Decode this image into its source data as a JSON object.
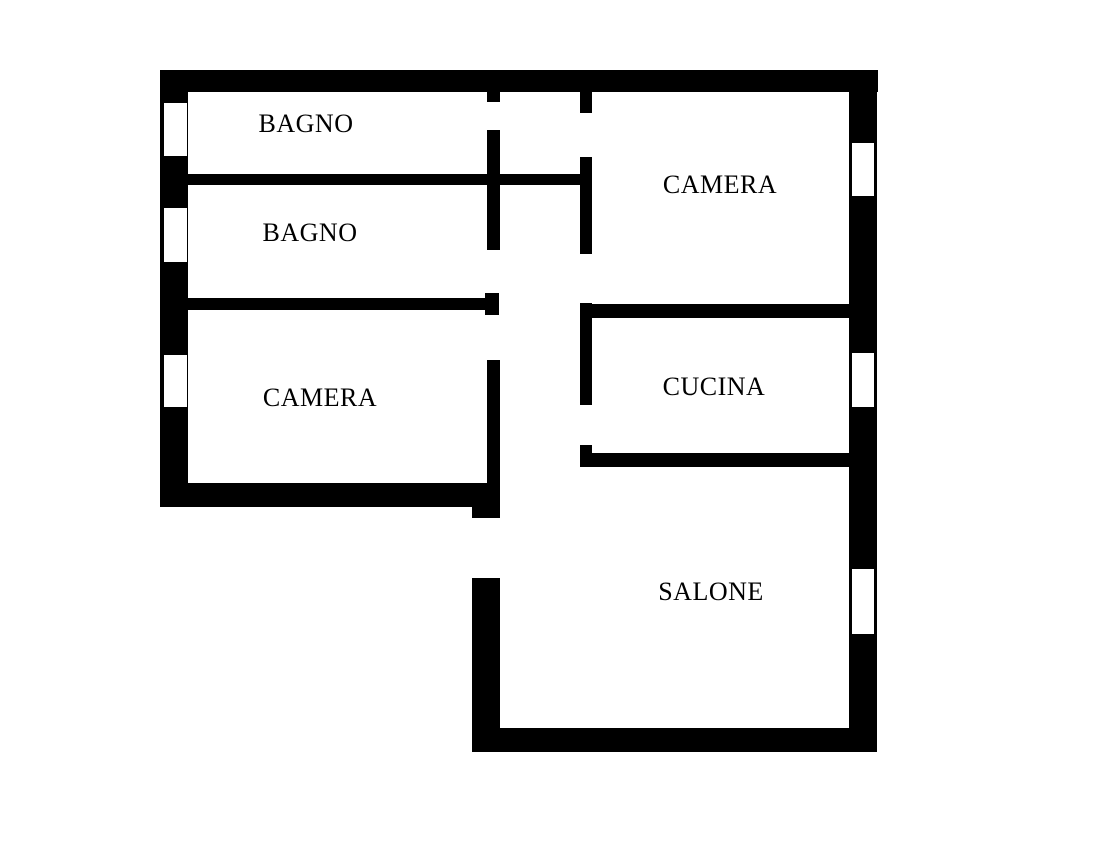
{
  "plan": {
    "width": 1106,
    "height": 843,
    "background": "#ffffff",
    "wall_color": "#000000",
    "window_fill": "#ffffff",
    "walls": [
      {
        "name": "exterior-wall-top",
        "x": 160,
        "y": 70,
        "w": 718,
        "h": 22
      },
      {
        "name": "exterior-wall-left",
        "x": 160,
        "y": 70,
        "w": 28,
        "h": 437
      },
      {
        "name": "exterior-wall-right",
        "x": 849,
        "y": 70,
        "w": 28,
        "h": 682
      },
      {
        "name": "exterior-wall-bottom-salone",
        "x": 472,
        "y": 728,
        "w": 405,
        "h": 24
      },
      {
        "name": "exterior-wall-bottom-camera",
        "x": 160,
        "y": 483,
        "w": 340,
        "h": 24
      },
      {
        "name": "entrance-jamb-upper",
        "x": 472,
        "y": 507,
        "w": 28,
        "h": 11
      },
      {
        "name": "exterior-wall-left-salone",
        "x": 472,
        "y": 578,
        "w": 28,
        "h": 150
      },
      {
        "name": "divider-bagno1-bagno2",
        "x": 188,
        "y": 174,
        "w": 404,
        "h": 11
      },
      {
        "name": "divider-bagno2-camera",
        "x": 188,
        "y": 298,
        "w": 297,
        "h": 12
      },
      {
        "name": "divider-camera-cucina",
        "x": 580,
        "y": 304,
        "w": 269,
        "h": 14
      },
      {
        "name": "divider-cucina-salone",
        "x": 580,
        "y": 453,
        "w": 269,
        "h": 14
      },
      {
        "name": "hall-wall-left-stub-top",
        "x": 487,
        "y": 92,
        "w": 13,
        "h": 10
      },
      {
        "name": "hall-wall-left-upper",
        "x": 487,
        "y": 130,
        "w": 13,
        "h": 120
      },
      {
        "name": "hall-wall-left-stub-mid",
        "x": 485,
        "y": 293,
        "w": 14,
        "h": 22
      },
      {
        "name": "hall-wall-left-lower",
        "x": 487,
        "y": 360,
        "w": 13,
        "h": 123
      },
      {
        "name": "hall-wall-right-stub-top",
        "x": 580,
        "y": 92,
        "w": 12,
        "h": 21
      },
      {
        "name": "hall-wall-right-upper",
        "x": 580,
        "y": 157,
        "w": 12,
        "h": 97
      },
      {
        "name": "hall-wall-right-cucina",
        "x": 580,
        "y": 303,
        "w": 12,
        "h": 102
      },
      {
        "name": "hall-wall-right-stub-bottom",
        "x": 580,
        "y": 445,
        "w": 12,
        "h": 22
      }
    ],
    "windows": [
      {
        "name": "window-bagno-1",
        "x": 164,
        "y": 103,
        "w": 23,
        "h": 53
      },
      {
        "name": "window-bagno-2",
        "x": 164,
        "y": 208,
        "w": 23,
        "h": 54
      },
      {
        "name": "window-camera-left",
        "x": 164,
        "y": 355,
        "w": 23,
        "h": 52
      },
      {
        "name": "window-camera-right",
        "x": 852,
        "y": 143,
        "w": 22,
        "h": 53
      },
      {
        "name": "window-cucina",
        "x": 852,
        "y": 353,
        "w": 22,
        "h": 54
      },
      {
        "name": "window-salone",
        "x": 852,
        "y": 569,
        "w": 22,
        "h": 65
      }
    ],
    "door_openings": [
      {
        "name": "door-bagno-1",
        "x": 487,
        "y": 102,
        "w": 13,
        "h": 28
      },
      {
        "name": "door-bagno-2",
        "x": 487,
        "y": 250,
        "w": 13,
        "h": 43
      },
      {
        "name": "door-camera-left",
        "x": 487,
        "y": 315,
        "w": 13,
        "h": 45
      },
      {
        "name": "door-camera-right-vestibule",
        "x": 580,
        "y": 113,
        "w": 12,
        "h": 44
      },
      {
        "name": "door-camera-right-corridor",
        "x": 580,
        "y": 254,
        "w": 12,
        "h": 49
      },
      {
        "name": "door-cucina",
        "x": 580,
        "y": 405,
        "w": 12,
        "h": 40
      },
      {
        "name": "main-entrance-opening",
        "x": 472,
        "y": 518,
        "w": 28,
        "h": 60
      }
    ]
  },
  "rooms": [
    {
      "id": "bagno-1",
      "label": "BAGNO",
      "cx": 306,
      "cy": 124
    },
    {
      "id": "bagno-2",
      "label": "BAGNO",
      "cx": 310,
      "cy": 233
    },
    {
      "id": "camera-left",
      "label": "CAMERA",
      "cx": 320,
      "cy": 398
    },
    {
      "id": "camera-right",
      "label": "CAMERA",
      "cx": 720,
      "cy": 185
    },
    {
      "id": "cucina",
      "label": "CUCINA",
      "cx": 714,
      "cy": 387
    },
    {
      "id": "salone",
      "label": "SALONE",
      "cx": 711,
      "cy": 592
    }
  ]
}
